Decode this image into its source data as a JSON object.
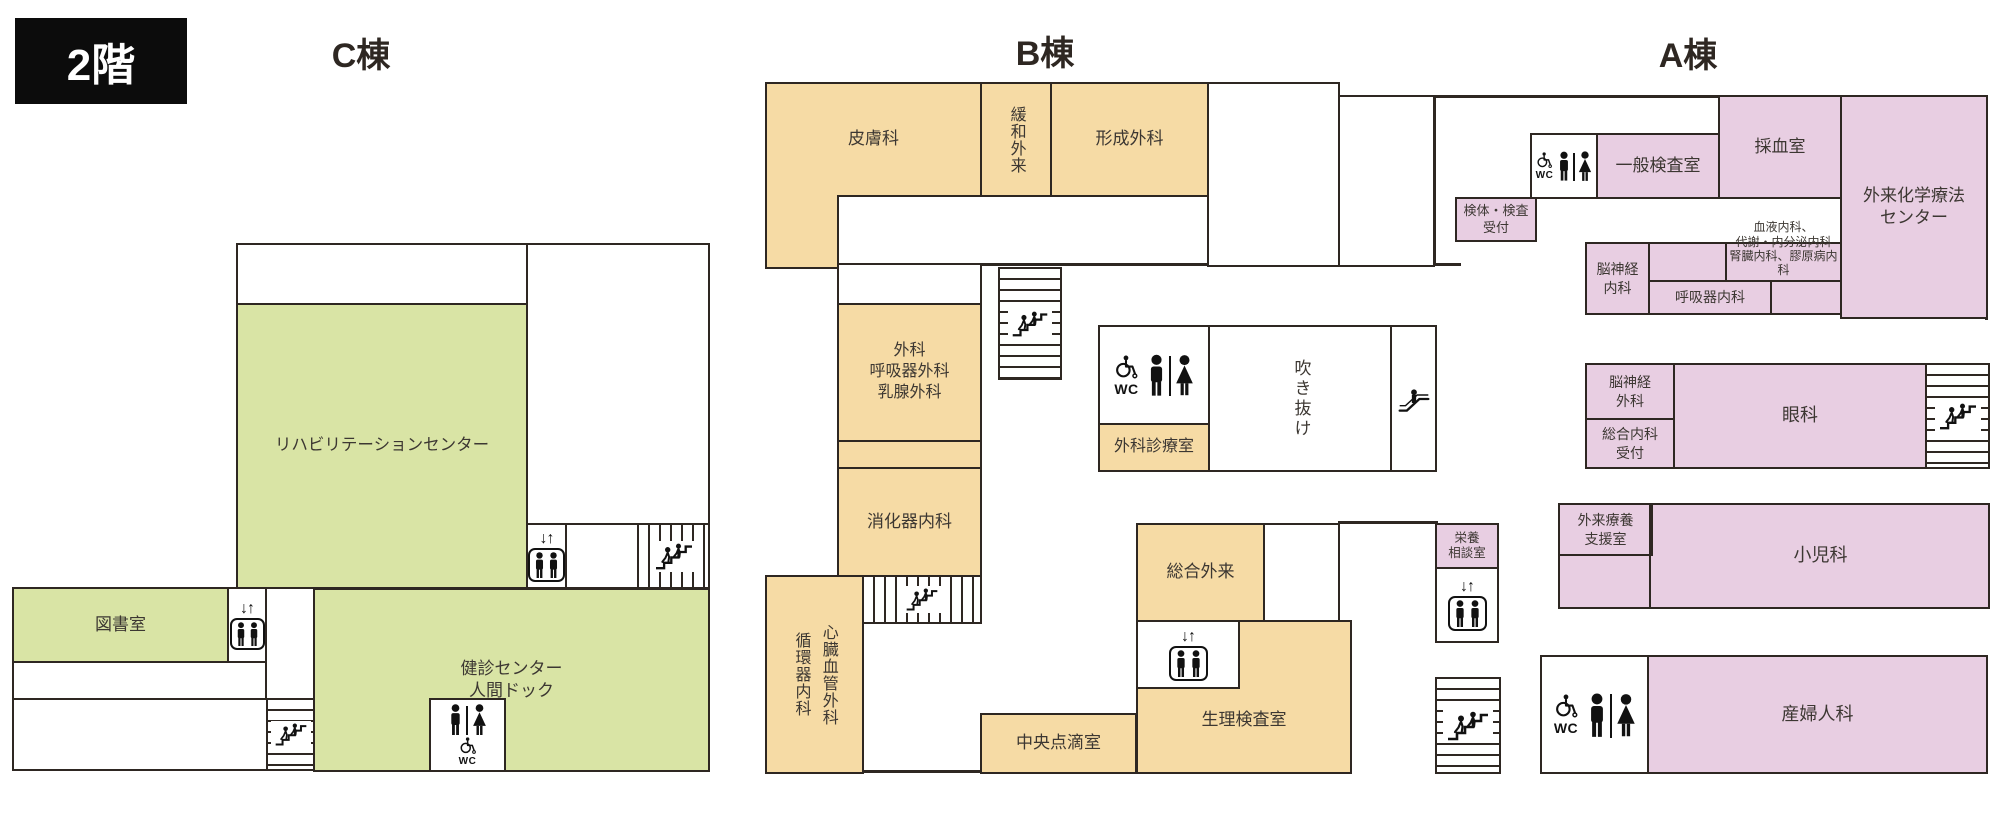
{
  "header": {
    "floor": "2階",
    "building_c": "C棟",
    "building_b": "B棟",
    "building_a": "A棟"
  },
  "icons": {
    "wc": "WC",
    "elevator_arrows": "↓↑"
  },
  "rooms": {
    "rehab": "リハビリテーションセンター",
    "library": "図書室",
    "kenshin": "健診センター\n人間ドック",
    "hifuka": "皮膚科",
    "kanwa": "緩和外来",
    "keisei": "形成外科",
    "geka": "外科\n呼吸器外科\n乳腺外科",
    "shokaki": "消化器内科",
    "shinzo": "心臓血管外科\n循環器内科",
    "chuo": "中央点滴室",
    "gekashinryo": "外科診療室",
    "fukinuke": "吹き抜け",
    "sogo_gairai": "総合外来",
    "seiri": "生理検査室",
    "eiyo": "栄養\n相談室",
    "kentai": "検体・検査\n受付",
    "ippan": "一般検査室",
    "saiketsu": "採血室",
    "kagaku": "外来化学療法\nセンター",
    "ketsueki": "血液内科、\n代謝・内分泌内科\n腎臓内科、膠原病内科",
    "noshinkei_naika": "脳神経\n内科",
    "kokyuki": "呼吸器内科",
    "noshinkei_geka": "脳神経\n外科",
    "sogo_naika": "総合内科\n受付",
    "ganka": "眼科",
    "gairai_ryoyo": "外来療養\n支援室",
    "shonika": "小児科",
    "sanfujinka": "産婦人科"
  },
  "colors": {
    "building_c_fill": "#d9e4a5",
    "building_b_fill": "#f6dba5",
    "building_a_fill": "#e8cee2",
    "wall": "#2e2722",
    "floor_badge_bg": "#0c0c0c"
  }
}
